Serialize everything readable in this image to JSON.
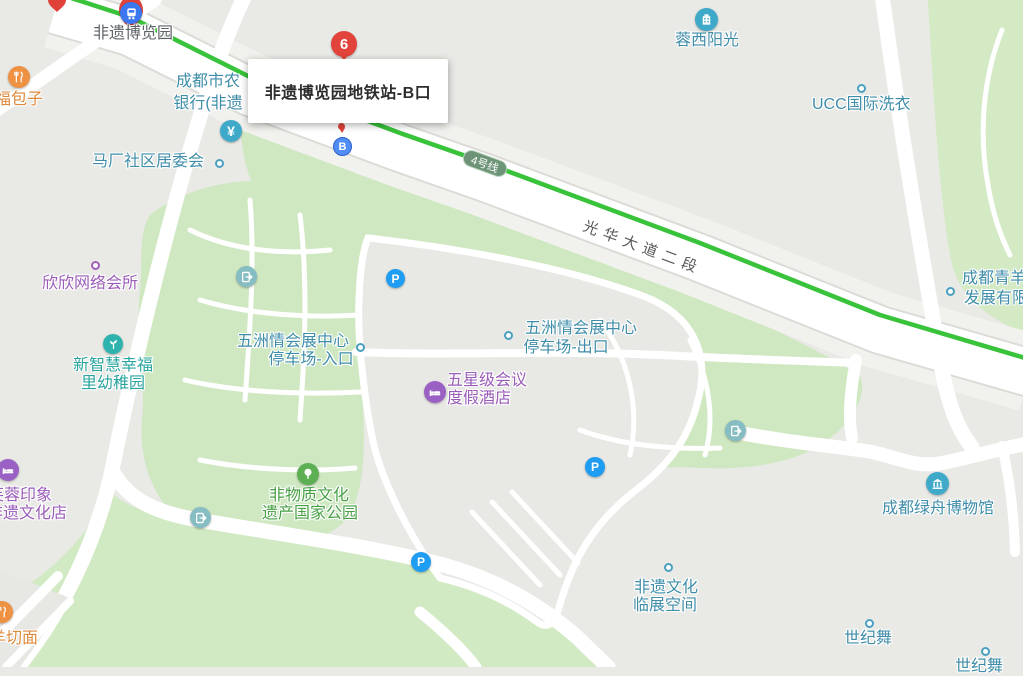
{
  "map": {
    "station_popup": {
      "title": "非遗博览园地铁站-B口"
    },
    "transit": {
      "line_badge": "4号线",
      "road_label": "光华大道二段"
    },
    "markers": {
      "numbered_marker": "6",
      "exit_letter": "B",
      "parking_letter": "P",
      "bank_glyph": "¥"
    },
    "colors": {
      "metro_line": "#38c33a",
      "park_green": "#cfe8c1",
      "road": "#ffffff",
      "background": "#e9e9e6",
      "poi_teal": "#3f8da8",
      "poi_purple": "#9a5cb8",
      "poi_orange": "#dd8a3c",
      "poi_green": "#47a044",
      "marker_red": "#e2433b",
      "parking_blue": "#1e9df2",
      "exit_blue": "#4f8df5"
    },
    "pois": {
      "station": {
        "label": "非遗博览园",
        "icon": "metro-train-icon"
      },
      "baozi": {
        "label": "幸福包子",
        "icon": "restaurant-icon"
      },
      "bank": {
        "line1": "成都市农",
        "line2": "银行(非遗",
        "icon": "bank-yuan-icon"
      },
      "community": {
        "label": "马厂社区居委会"
      },
      "rongxi": {
        "label": "蓉西阳光",
        "icon": "building-icon"
      },
      "ucc": {
        "label": "UCC国际洗衣"
      },
      "qingyang": {
        "line1": "成都青羊",
        "line2": "发展有限"
      },
      "xinxin": {
        "label": "欣欣网络会所"
      },
      "parking_entrance": {
        "line1": "五洲情会展中心",
        "line2": "停车场-入口"
      },
      "parking_exit": {
        "line1": "五洲情会展中心",
        "line2": "停车场-出口"
      },
      "hotel": {
        "line1": "五星级会议",
        "line2": "度假酒店",
        "icon": "hotel-bed-icon"
      },
      "kindergarten": {
        "line1": "新智慧幸福",
        "line2": "里幼稚园",
        "icon": "plant-icon"
      },
      "furong": {
        "line1": "芙蓉印象",
        "line2": "非遗文化店",
        "icon": "hotel-bed-icon"
      },
      "qiemian": {
        "label": "羊切面",
        "icon": "restaurant-icon"
      },
      "heritage_park": {
        "line1": "非物质文化",
        "line2": "遗产国家公园",
        "icon": "tree-icon"
      },
      "museum": {
        "label": "成都绿舟博物馆",
        "icon": "museum-icon"
      },
      "linzhan": {
        "line1": "非遗文化",
        "line2": "临展空间"
      },
      "shijiwu": {
        "label": "世纪舞"
      },
      "shijiwu2": {
        "label": "世纪舞"
      }
    }
  }
}
